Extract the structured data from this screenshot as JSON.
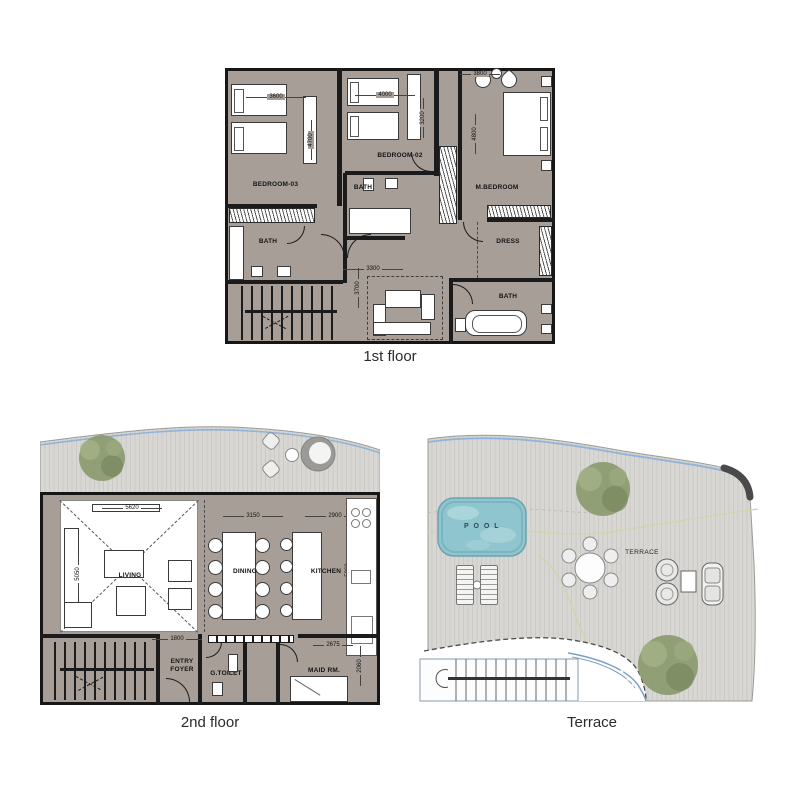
{
  "captions": {
    "floor1": "1st floor",
    "floor2": "2nd floor",
    "terrace": "Terrace"
  },
  "floor1": {
    "labels": {
      "bedroom03": "BEDROOM-03",
      "bedroom02": "BEDROOM-02",
      "mbedroom": "M.BEDROOM",
      "bath_center": "BATH",
      "bath_left": "BATH",
      "dress": "DRESS",
      "bath_right": "BATH"
    },
    "dims": {
      "bedroom03_w": "3600",
      "bedroom03_h": "4700",
      "bedroom02_w": "4000",
      "bedroom02_h": "3200",
      "mbedroom_w": "3800",
      "mbedroom_h": "4800",
      "family_w": "3300",
      "family_h": "3700"
    }
  },
  "floor2": {
    "labels": {
      "living": "LIVING",
      "dining": "DINING",
      "kitchen": "KITCHEN",
      "entry": "ENTRY FOYER",
      "gtoilet": "G.TOILET",
      "maid": "MAID RM."
    },
    "dims": {
      "living_w": "5620",
      "living_h": "5050",
      "dining_w": "3150",
      "kitchen_w": "2900",
      "kitchen_h": "5060",
      "entry_w": "1800",
      "maid_w": "2675",
      "maid_h": "2060"
    }
  },
  "terrace": {
    "labels": {
      "pool": "P O O L",
      "terrace": "TERRACE"
    }
  },
  "colors": {
    "floor": "#a69e97",
    "wall": "#1b1b1b",
    "deck": "#d8d7d4",
    "deck_stripe": "#cac9c5",
    "pool_water": "#8fc5ce",
    "tree_green": "#8d9c71",
    "railing_blue": "#8fb3d9",
    "label_text": "#141414"
  }
}
